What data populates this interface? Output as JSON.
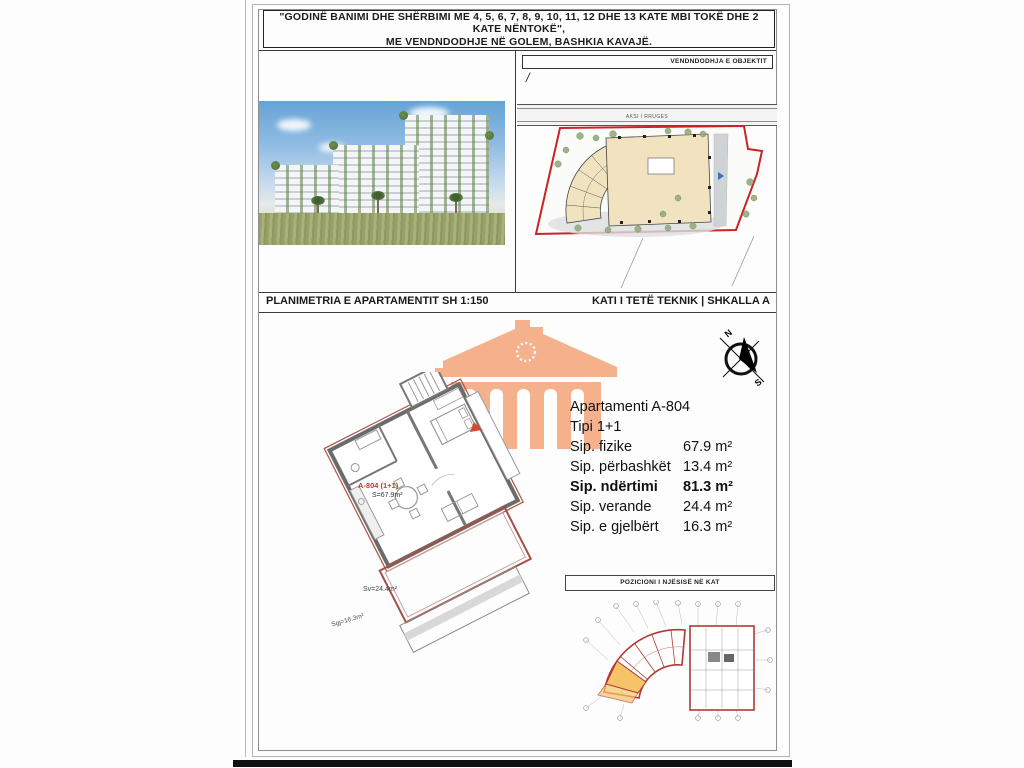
{
  "title": {
    "line1": "\"GODINË BANIMI DHE SHËRBIMI ME 4, 5, 6, 7, 8, 9, 10, 11, 12 DHE 13 KATE MBI TOKË DHE 2 KATE NËNTOKË\",",
    "line2": "ME VENDNDODHJE NË GOLEM, BASHKIA KAVAJË."
  },
  "site_panel": {
    "box_label": "VENDNDODHJA E OBJEKTIT",
    "slash": "/",
    "road_label": "AKSI I RRUGES"
  },
  "section_header": {
    "left": "PLANIMETRIA E APARTAMENTIT SH 1:150",
    "right": "KATI I TETË TEKNIK | SHKALLA A"
  },
  "plan_labels": {
    "unit": "A-804 (1+1)",
    "unit_area": "S=67.9m²",
    "veranda_area": "Sv=24.4m²",
    "green_area": "Sgj=16.3m²"
  },
  "compass": {
    "north": "N",
    "south": "S"
  },
  "info": {
    "title": "Apartamenti A-804",
    "type": "Tipi 1+1",
    "rows": [
      {
        "label": "Sip. fizike",
        "value": "67.9 m²"
      },
      {
        "label": "Sip. përbashkët",
        "value": "13.4 m²"
      },
      {
        "label": "Sip. ndërtimi",
        "value": "81.3 m²"
      },
      {
        "label": "Sip. verande",
        "value": "24.4 m²"
      },
      {
        "label": "Sip. e gjelbërt",
        "value": "16.3 m²"
      }
    ]
  },
  "keyplan": {
    "label": "POZICIONI I NJËSISË NË KAT"
  },
  "colors": {
    "boundary_red": "#cc2222",
    "plan_red": "#b03a33",
    "building_beige": "#f2e3c0",
    "watermark_orange": "#f4b18c",
    "highlight_unit": "#f5c469"
  }
}
